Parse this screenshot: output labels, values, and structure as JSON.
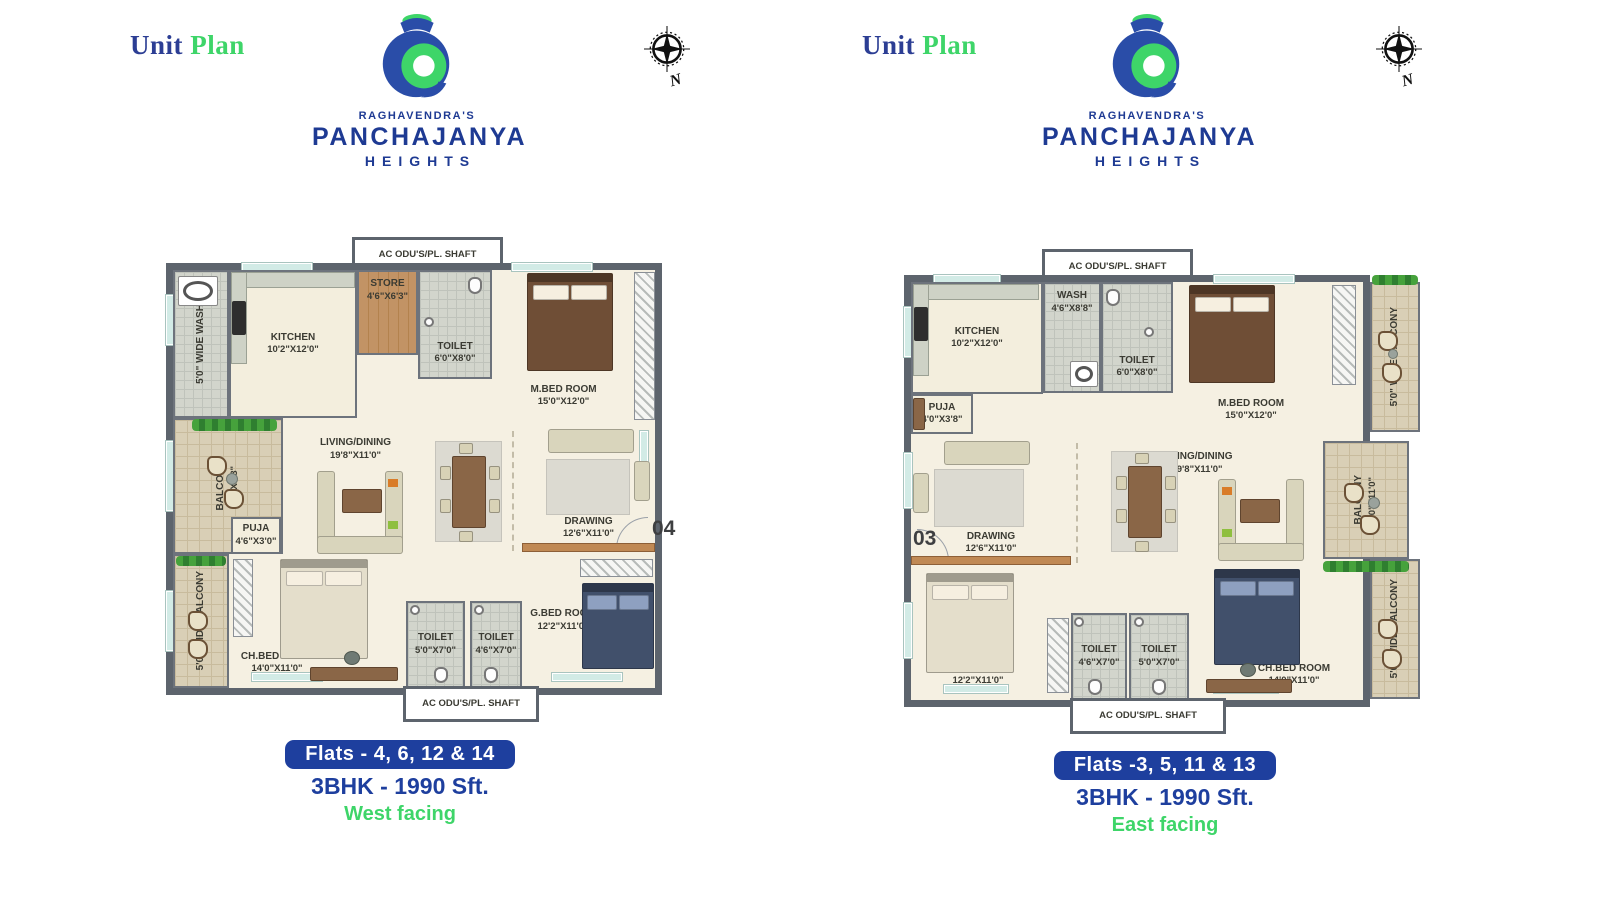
{
  "header": {
    "word1": "Unit",
    "word2": "Plan"
  },
  "brand": {
    "prefix": "RAGHAVENDRA'S",
    "name": "PANCHAJANYA",
    "suffix": "HEIGHTS"
  },
  "compass": {
    "label": "N"
  },
  "colors": {
    "wall": "#5d646d",
    "floor_cream": "#f5f0e2",
    "floor_balcony": "#d9cfb6",
    "floor_tile": "#d2d5cc",
    "floor_wood": "#bc8d5e",
    "accent_blue": "#1e3f9e",
    "accent_green": "#3ed569",
    "label_text": "#3b3b33"
  },
  "icons": {
    "conch_logo": "blue-green-swirl-shell",
    "compass_rose": "8-point-star-circle",
    "double_bed": "rect-with-pillows",
    "sofa": "beige-rect",
    "armchair": "small-rect",
    "dining_table": "wood-rect-8-chairs",
    "coffee_table": "wood-rect",
    "balcony_chair": "round-corner-square",
    "side_table": "circle",
    "plant": "green-strip",
    "wardrobe": "hatched-strip",
    "kitchen_counter": "gray-strip",
    "hob": "dark-square",
    "washing_machine": "square-with-drum",
    "wc": "rounded-pan",
    "wash_basin": "circle",
    "desk": "wood-strip",
    "desk_chair": "dark-circle",
    "window": "teal-strip",
    "door": "quarter-arc"
  },
  "plans": {
    "west": {
      "shaft_top": "AC ODU'S/PL. SHAFT",
      "shaft_bottom": "AC ODU'S/PL. SHAFT",
      "flat_badge": "04",
      "rooms": {
        "wash_strip": {
          "label": "5'0\" WIDE WASH"
        },
        "kitchen": {
          "label": "KITCHEN",
          "dims": "10'2\"X12'0\""
        },
        "store": {
          "label": "STORE",
          "dims": "4'6\"X6'3\""
        },
        "toilet_top": {
          "label": "TOILET",
          "dims": "6'0\"X8'0\""
        },
        "master_bed": {
          "label": "M.BED ROOM",
          "dims": "15'0\"X12'0\""
        },
        "balcony": {
          "label": "BALCONY",
          "dims": "8'0\"X7'8\""
        },
        "puja": {
          "label": "PUJA",
          "dims": "4'6\"X3'0\""
        },
        "living": {
          "label": "LIVING/DINING",
          "dims": "19'8\"X11'0\""
        },
        "drawing": {
          "label": "DRAWING",
          "dims": "12'6\"X11'0\""
        },
        "balcony_strip": {
          "label": "5'0\" WIDE BALCONY"
        },
        "child_bed": {
          "label": "CH.BED ROOM",
          "dims": "14'0\"X11'0\""
        },
        "toilet_one": {
          "label": "TOILET",
          "dims": "5'0\"X7'0\""
        },
        "toilet_two": {
          "label": "TOILET",
          "dims": "4'6\"X7'0\""
        },
        "guest_bed": {
          "label": "G.BED ROOM",
          "dims": "12'2\"X11'0\""
        }
      },
      "caption": {
        "flats": "Flats - 4, 6, 12 & 14",
        "spec": "3BHK - 1990 Sft.",
        "facing": "West facing"
      }
    },
    "east": {
      "shaft_top": "AC ODU'S/PL. SHAFT",
      "shaft_bottom": "AC ODU'S/PL. SHAFT",
      "flat_badge": "03",
      "rooms": {
        "kitchen": {
          "label": "KITCHEN",
          "dims": "10'2\"X12'0\""
        },
        "puja": {
          "label": "PUJA",
          "dims": "4'0\"X3'8\""
        },
        "wash": {
          "label": "WASH",
          "dims": "4'6\"X8'8\""
        },
        "toilet_top": {
          "label": "TOILET",
          "dims": "6'0\"X8'0\""
        },
        "master_bed": {
          "label": "M.BED ROOM",
          "dims": "15'0\"X12'0\""
        },
        "balcony_strip_top": {
          "label": "5'0\" WIDE BALCONY"
        },
        "drawing": {
          "label": "DRAWING",
          "dims": "12'6\"X11'0\""
        },
        "living": {
          "label": "LIVING/DINING",
          "dims": "19'8\"X11'0\""
        },
        "balcony": {
          "label": "BALCONY",
          "dims": "8'0\"X11'0\""
        },
        "guest_bed": {
          "label": "G.BED ROOM",
          "dims": "12'2\"X11'0\""
        },
        "toilet_one": {
          "label": "TOILET",
          "dims": "4'6\"X7'0\""
        },
        "toilet_two": {
          "label": "TOILET",
          "dims": "5'0\"X7'0\""
        },
        "child_bed": {
          "label": "CH.BED ROOM",
          "dims": "14'0\"X11'0\""
        },
        "balcony_strip_bottom": {
          "label": "5'0\" WIDE BALCONY"
        }
      },
      "caption": {
        "flats": "Flats -3, 5, 11 & 13",
        "spec": "3BHK - 1990 Sft.",
        "facing": "East facing"
      }
    }
  }
}
